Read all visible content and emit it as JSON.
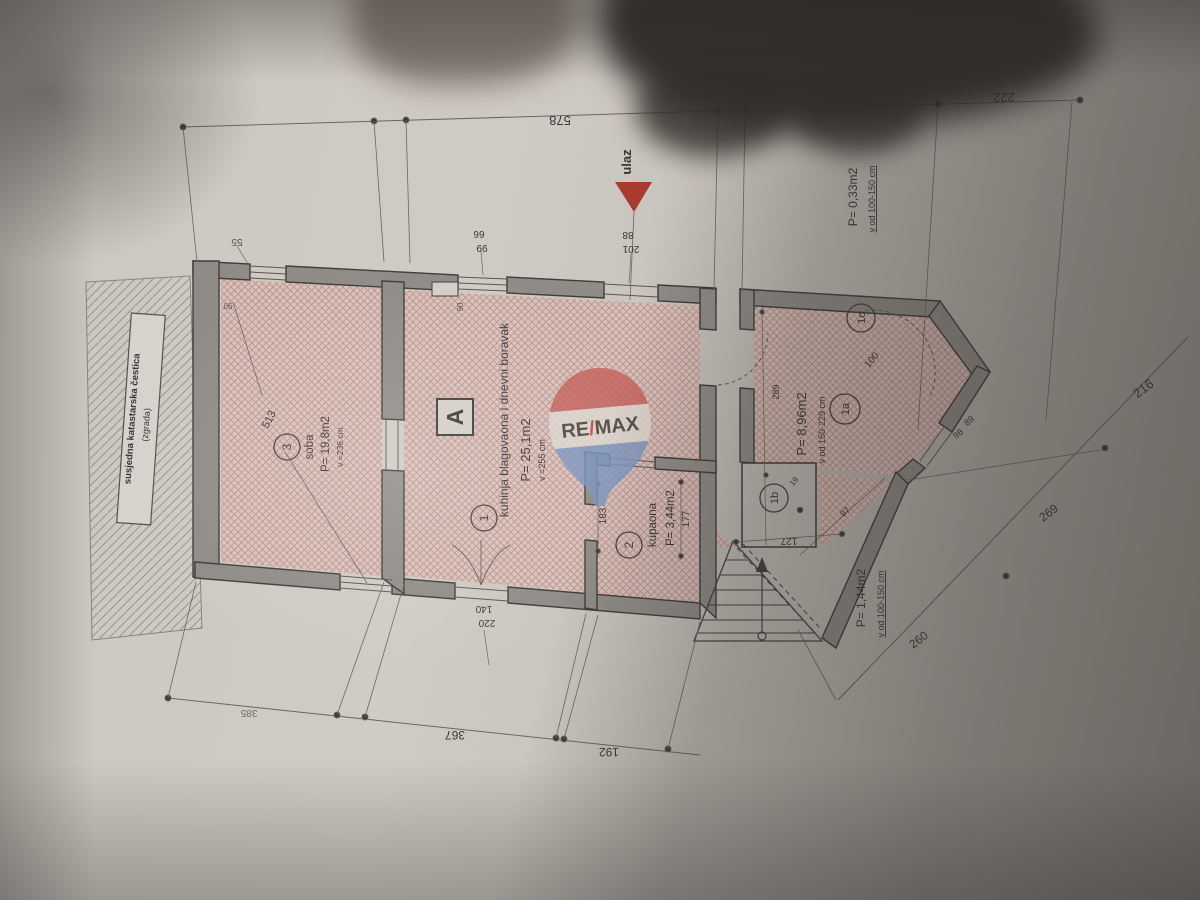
{
  "watermark": {
    "re": "RE",
    "slash": "/",
    "max": "MAX"
  },
  "entrance": {
    "label": "ulaz",
    "door_width": "88",
    "door_height": "201"
  },
  "rooms": {
    "kitchen": {
      "number": "1",
      "name": "kuhinja blagovaona i dnevni boravak",
      "area": "P= 25,1m2",
      "height": "v =255 cm"
    },
    "bathroom": {
      "number": "2",
      "name": "kupaona",
      "area": "P= 3,44m2"
    },
    "bedroom": {
      "number": "3",
      "name": "soba",
      "area": "P= 19,8m2",
      "height": "v =236 cm"
    },
    "attic_1a": {
      "number": "1a",
      "area": "P= 8,96m2",
      "height": "v od 150-229 cm",
      "side": "289"
    },
    "attic_1b": {
      "number": "1b"
    },
    "attic_1c": {
      "number": "1c"
    },
    "zone_033": {
      "area": "P= 0,33m2",
      "height": "v od 100-150 cm"
    },
    "zone_144": {
      "area": "P= 1,44m2",
      "height": "v od 100-150 cm"
    }
  },
  "marker_a": "A",
  "neighbor": {
    "line1": "susjedna katastarska čestica",
    "line2": "(zgrada)"
  },
  "dims": {
    "top": [
      "578",
      "323",
      "222"
    ],
    "bottom": [
      "385",
      "367",
      "192"
    ],
    "boundary": [
      "216",
      "269",
      "260"
    ],
    "bedroom_diagonal": "513",
    "bathroom": [
      "183",
      "177"
    ],
    "stairs": "127",
    "door_swing": "100",
    "d97": "97",
    "d89": "89",
    "d98": "98",
    "d19": "19",
    "bedroom_window": {
      "top": "55",
      "size": "90"
    },
    "kitchen_window": {
      "w": "66",
      "h": "99",
      "size": "90"
    },
    "terrace_door": {
      "w": "140",
      "h": "220"
    }
  },
  "colors": {
    "entrance_arrow": "#a83a30",
    "wall_fill": "#8f8b87",
    "room_hatch": "#d8c1bb",
    "logo_red": "#c4605b",
    "logo_blue": "#7b94c0",
    "logo_text": "#2d4b97"
  }
}
